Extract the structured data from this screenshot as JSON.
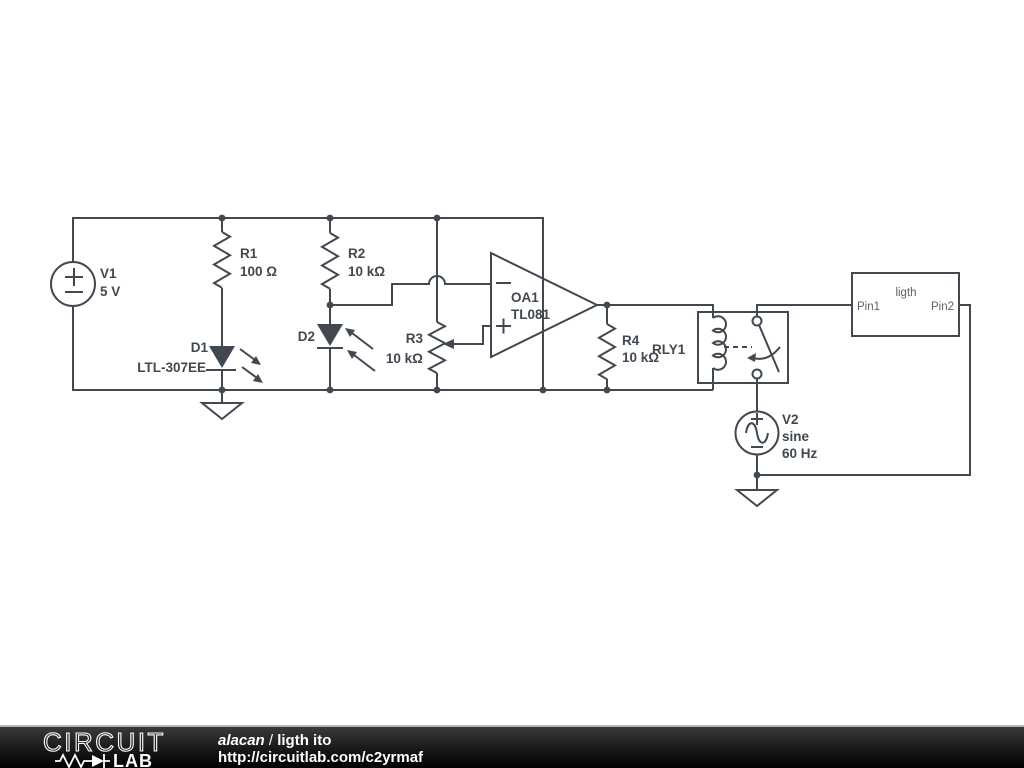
{
  "colors": {
    "wire": "#414850",
    "canvas": "#ffffff",
    "muted_label": "#5a6167",
    "footer_text": "#ffffff"
  },
  "components": {
    "v1": {
      "ref": "V1",
      "value": "5 V"
    },
    "r1": {
      "ref": "R1",
      "value": "100 Ω"
    },
    "r2": {
      "ref": "R2",
      "value": "10 kΩ"
    },
    "r3": {
      "ref": "R3",
      "value": "10 kΩ"
    },
    "r4": {
      "ref": "R4",
      "value": "10 kΩ"
    },
    "d1": {
      "ref": "D1",
      "value": "LTL-307EE"
    },
    "d2": {
      "ref": "D2"
    },
    "oa1": {
      "ref": "OA1",
      "value": "TL081"
    },
    "rly1": {
      "ref": "RLY1"
    },
    "v2": {
      "ref": "V2",
      "value": "sine",
      "freq": "60 Hz"
    },
    "ligth_box": {
      "title": "ligth",
      "pin1": "Pin1",
      "pin2": "Pin2"
    }
  },
  "footer": {
    "logo_top": "CIRCUIT",
    "logo_bottom": "LAB",
    "author": "alacan",
    "divider": "/",
    "project": "ligth ito",
    "url": "http://circuitlab.com/c2yrmaf"
  }
}
